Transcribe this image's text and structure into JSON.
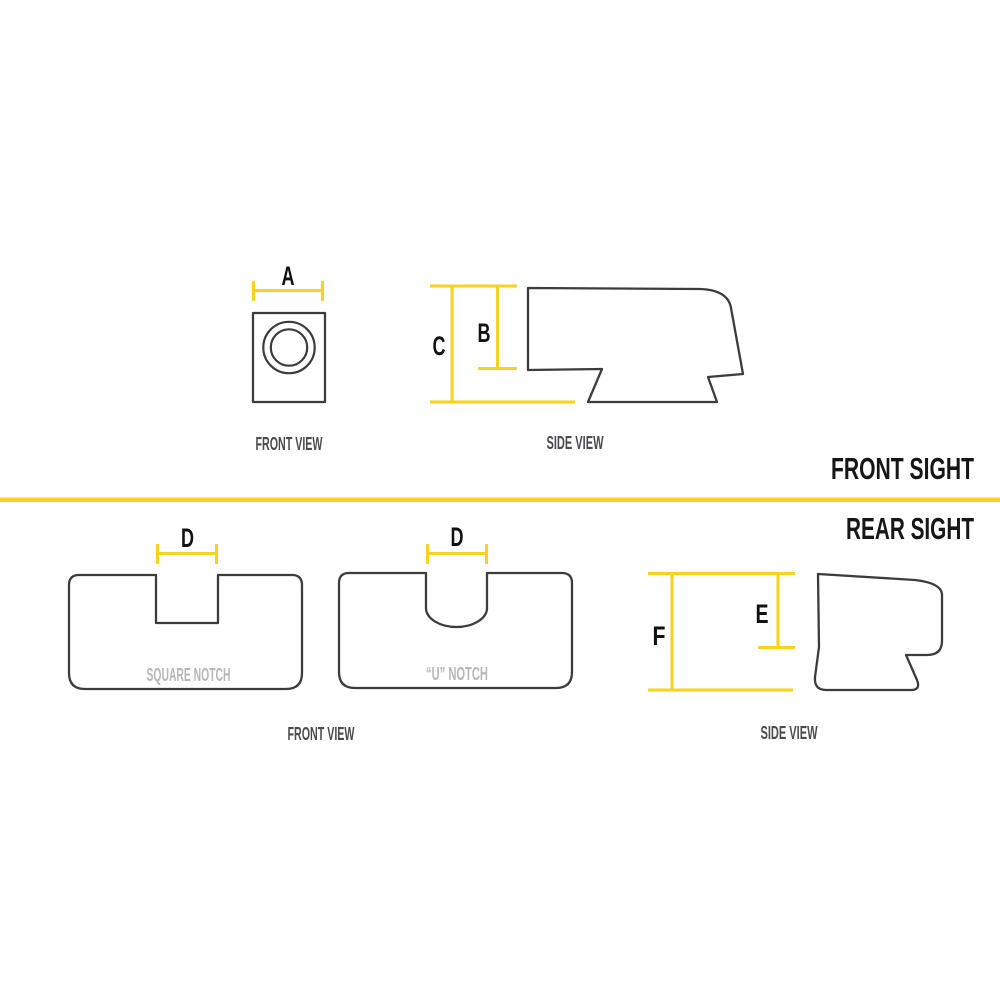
{
  "colors": {
    "accent": "#F7D21E",
    "outline": "#3C3C3F",
    "caption": "#4B4B4F",
    "muted": "#B7B7B7",
    "heading": "#161616"
  },
  "front_sight": {
    "section_label": "FRONT SIGHT",
    "front_view": {
      "caption": "FRONT VIEW",
      "dim_a": "A"
    },
    "side_view": {
      "caption": "SIDE VIEW",
      "dim_b": "B",
      "dim_c": "C"
    }
  },
  "rear_sight": {
    "section_label": "REAR SIGHT",
    "front_view": {
      "caption": "FRONT VIEW",
      "square_notch": {
        "label": "SQUARE NOTCH",
        "dim_d": "D"
      },
      "u_notch": {
        "label": "“U” NOTCH",
        "dim_d": "D"
      }
    },
    "side_view": {
      "caption": "SIDE VIEW",
      "dim_e": "E",
      "dim_f": "F"
    }
  }
}
